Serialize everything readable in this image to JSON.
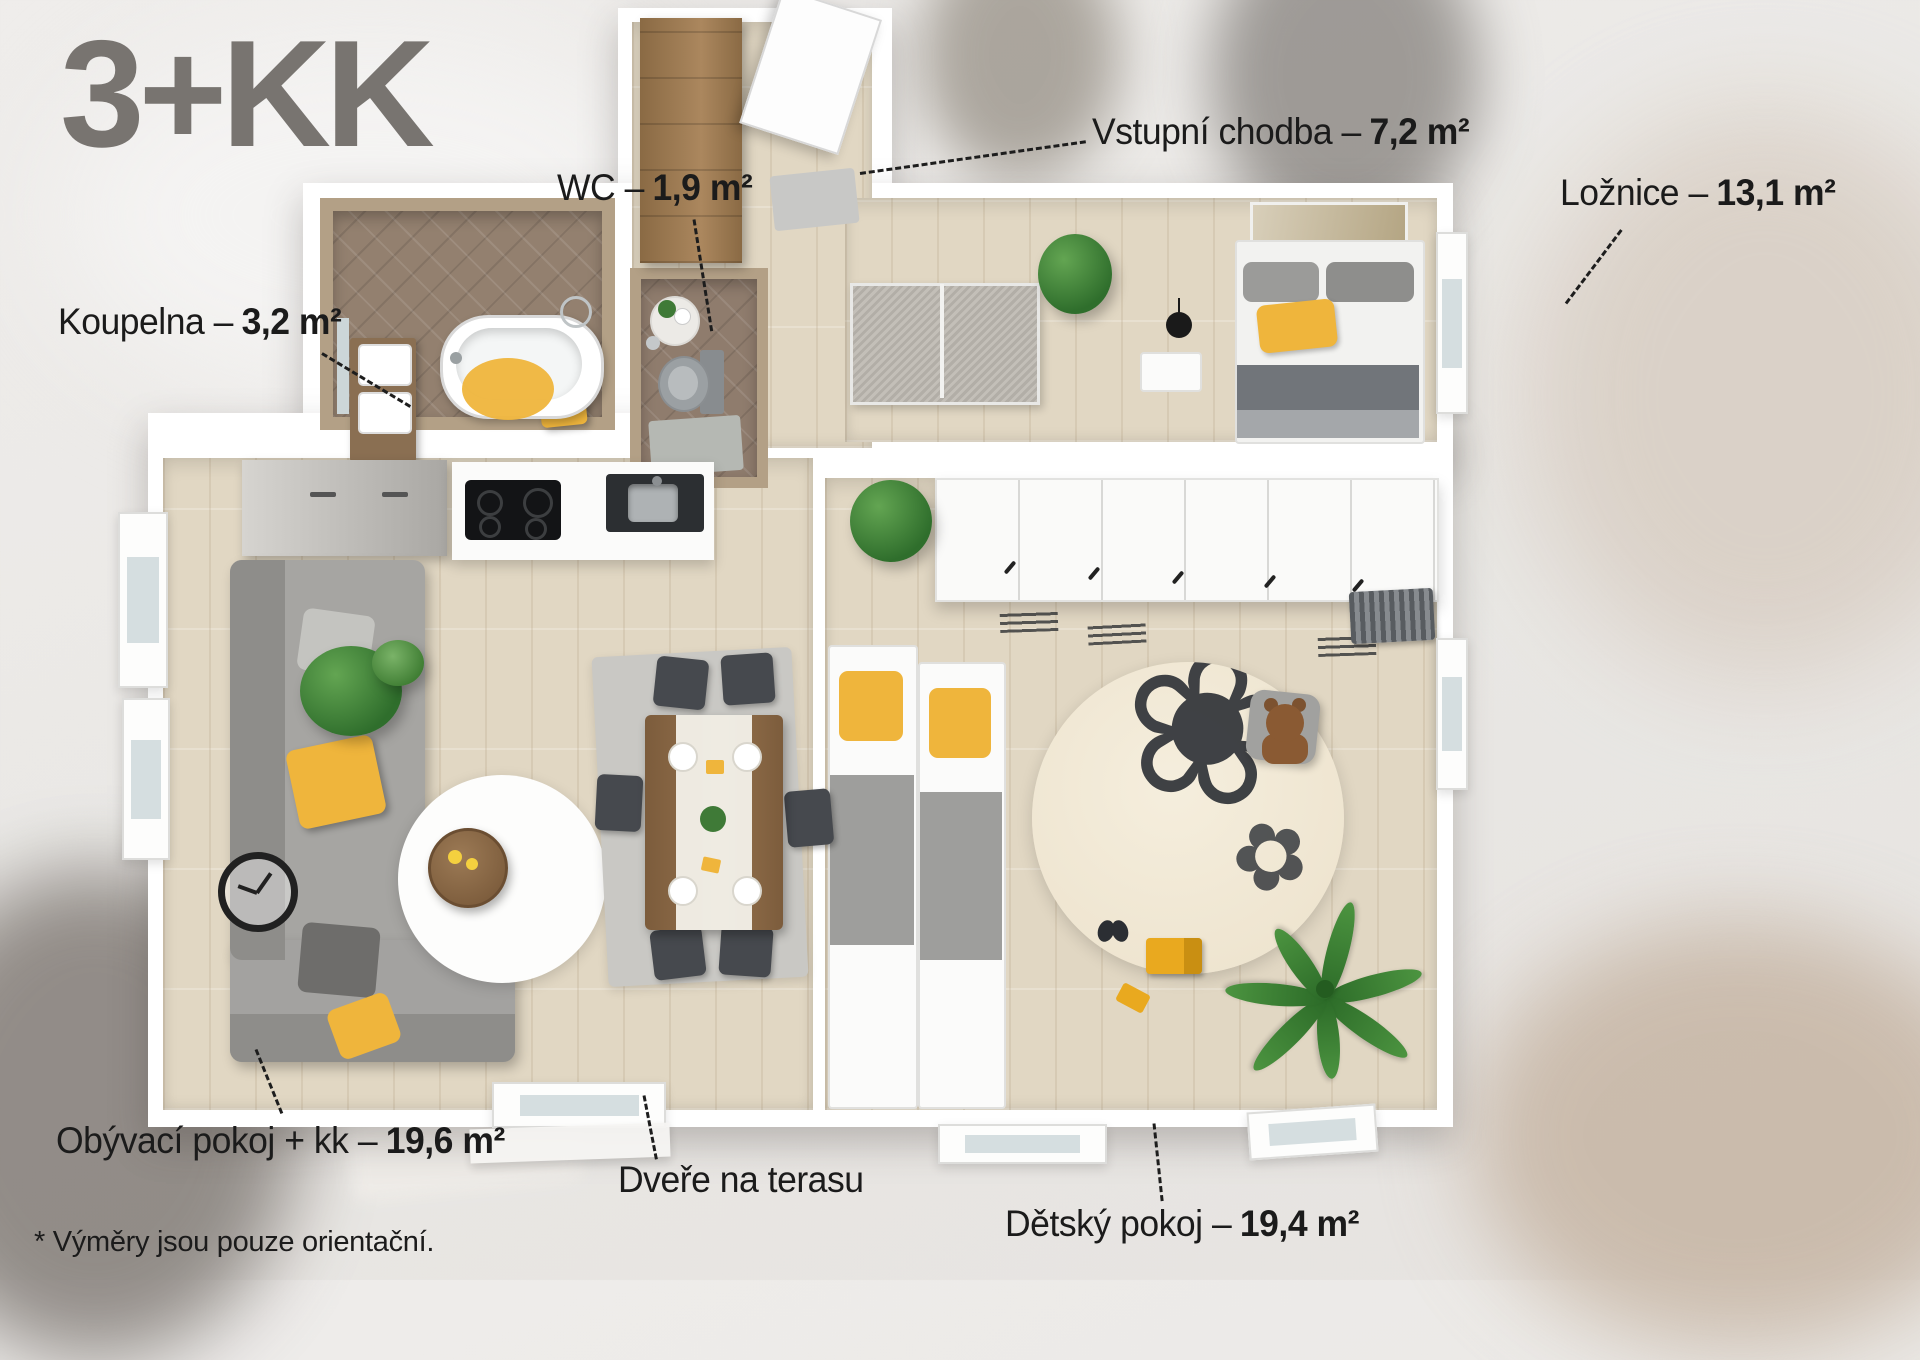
{
  "title": "3+KK",
  "footnote": "* Výměry jsou pouze orientační.",
  "labels": {
    "hall": {
      "name": "Vstupní chodba –",
      "area": "7,2 m²"
    },
    "wc": {
      "name": "WC –",
      "area": "1,9 m²"
    },
    "bedroom": {
      "name": "Ložnice –",
      "area": "13,1 m²"
    },
    "bathroom": {
      "name": "Koupelna –",
      "area": "3,2 m²"
    },
    "living": {
      "name": "Obývací pokoj + kk –",
      "area": "19,6 m²"
    },
    "kids": {
      "name": "Dětský pokoj –",
      "area": "19,4 m²"
    },
    "terrace": {
      "name": "Dveře na terasu",
      "area": ""
    }
  },
  "icons": {
    "flower_rug": "❀",
    "flower_rug_small": "✿"
  },
  "colors": {
    "accent_yellow": "#efb53c",
    "title_gray": "#787470",
    "text_black": "#1b1b1b",
    "wall_white": "#ffffff",
    "wood_floor": "#e1d7c3",
    "tile_brown": "#93806f",
    "wood_wall": "#b3a086"
  }
}
